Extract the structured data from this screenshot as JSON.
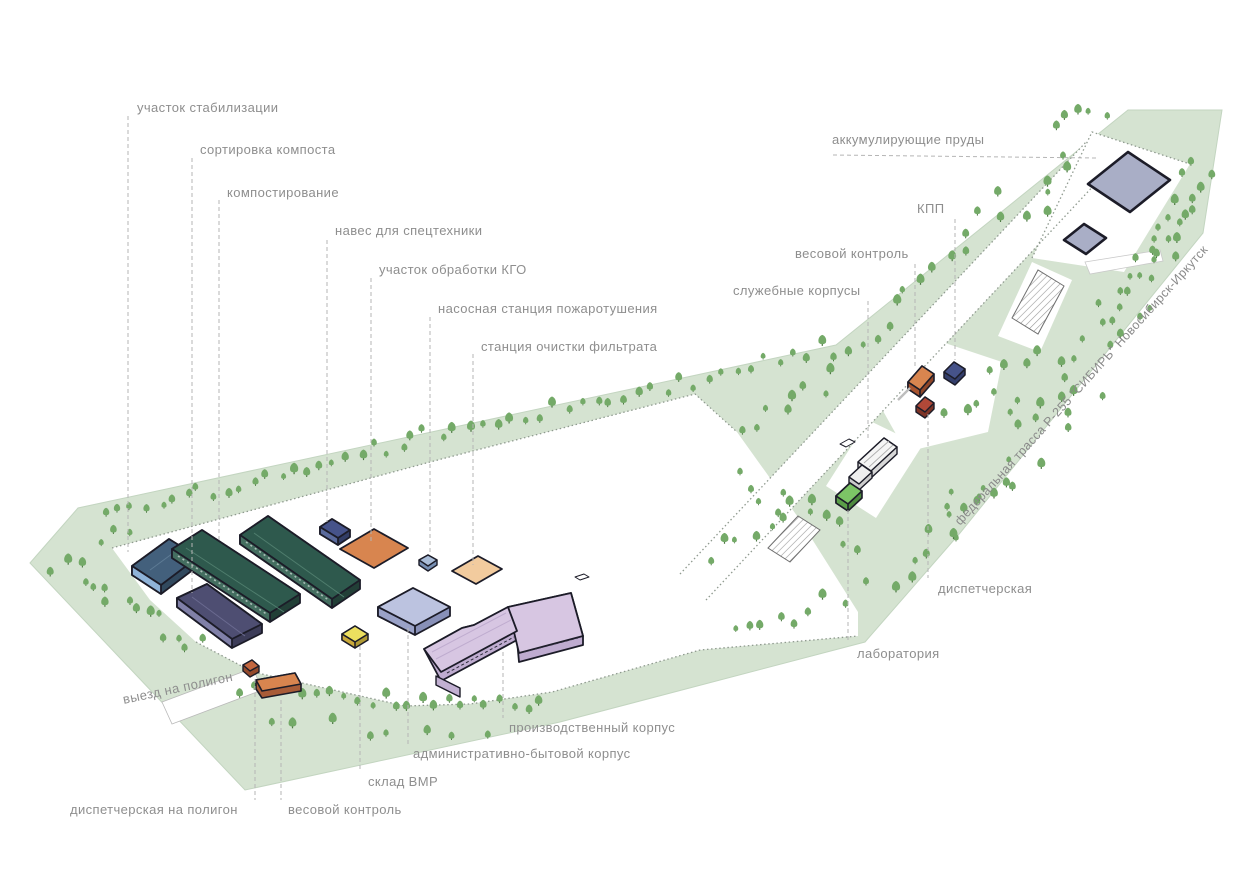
{
  "site_plan": {
    "title": "waste-processing-facility-site-plan",
    "labels": {
      "stabilization_area": "участок стабилизации",
      "compost_sorting": "сортировка компоста",
      "composting": "компостирование",
      "machinery_shed": "навес для спецтехники",
      "bulky_waste_area": "участок обработки КГО",
      "fire_pump_station": "насосная станция пожаротушения",
      "filtrate_treatment_station": "станция очистки фильтрата",
      "accumulating_ponds": "аккумулирующие пруды",
      "checkpoint": "КПП",
      "weight_control_entrance": "весовой контроль",
      "service_buildings": "служебные корпусы",
      "federal_highway": "федеральная трасса Р-255 \"СИБИРЬ\" Новосибирск-Иркутск",
      "dispatcher_office": "диспетчерская",
      "laboratory": "лаборатория",
      "production_building": "производственный корпус",
      "admin_building": "административно-бытовой корпус",
      "vmr_warehouse": "склад ВМР",
      "weight_control_landfill": "весовой контроль",
      "dispatcher_landfill": "диспетчерская на полигон",
      "landfill_exit": "выезд на полигон"
    },
    "colors": {
      "field_green": "#d5e3d1",
      "tree_green": "#74aa68",
      "label_gray": "#8e8e8e",
      "leader_gray": "#b5b5b5",
      "outline_dark": "#1c1c28",
      "hangar_green": "#2e594d",
      "hangar_blue": "#43607c",
      "hangar_purple": "#4e4e72",
      "building_pink": "#d7c6e2",
      "building_periwinkle": "#bcc3e0",
      "pad_orange": "#d8854f",
      "pad_peach": "#f2cb9e",
      "store_yellow": "#ecdf5f",
      "lab_green": "#7cc566",
      "kpp_navy": "#46538a",
      "pond_fill": "#a9aec6",
      "road_white": "#ffffff"
    }
  }
}
